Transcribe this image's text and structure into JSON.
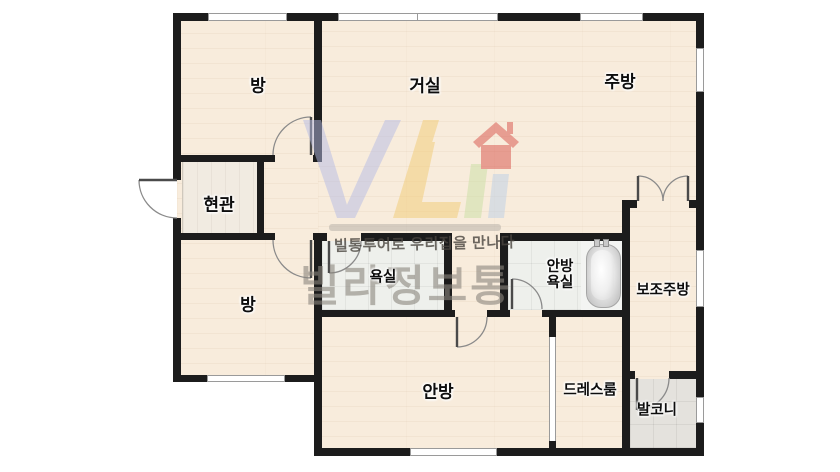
{
  "rooms": {
    "room1": "방",
    "living": "거실",
    "kitchen": "주방",
    "entrance": "현관",
    "bath": "욕실",
    "master_bath_l1": "안방",
    "master_bath_l2": "욕실",
    "aux_kitchen": "보조주방",
    "room2": "방",
    "master": "안방",
    "dressroom": "드레스룸",
    "balcony": "발코니"
  },
  "watermark": {
    "slogan": "빌통투어로 우리집을 만나다",
    "brand": "빌라정보통"
  },
  "colors": {
    "wall": "#1c1c1c",
    "wood_floor": "#f8ecdc",
    "entrance_floor": "#f1ebe1",
    "bath_tile": "#eef0ec",
    "balcony_tile": "#e4e2dd",
    "brand_gray": "#8b867e",
    "logo_blue": "#b6bce4",
    "logo_yellow": "#f2cb74",
    "logo_green": "#c9dfa4",
    "logo_red": "#d85048"
  }
}
